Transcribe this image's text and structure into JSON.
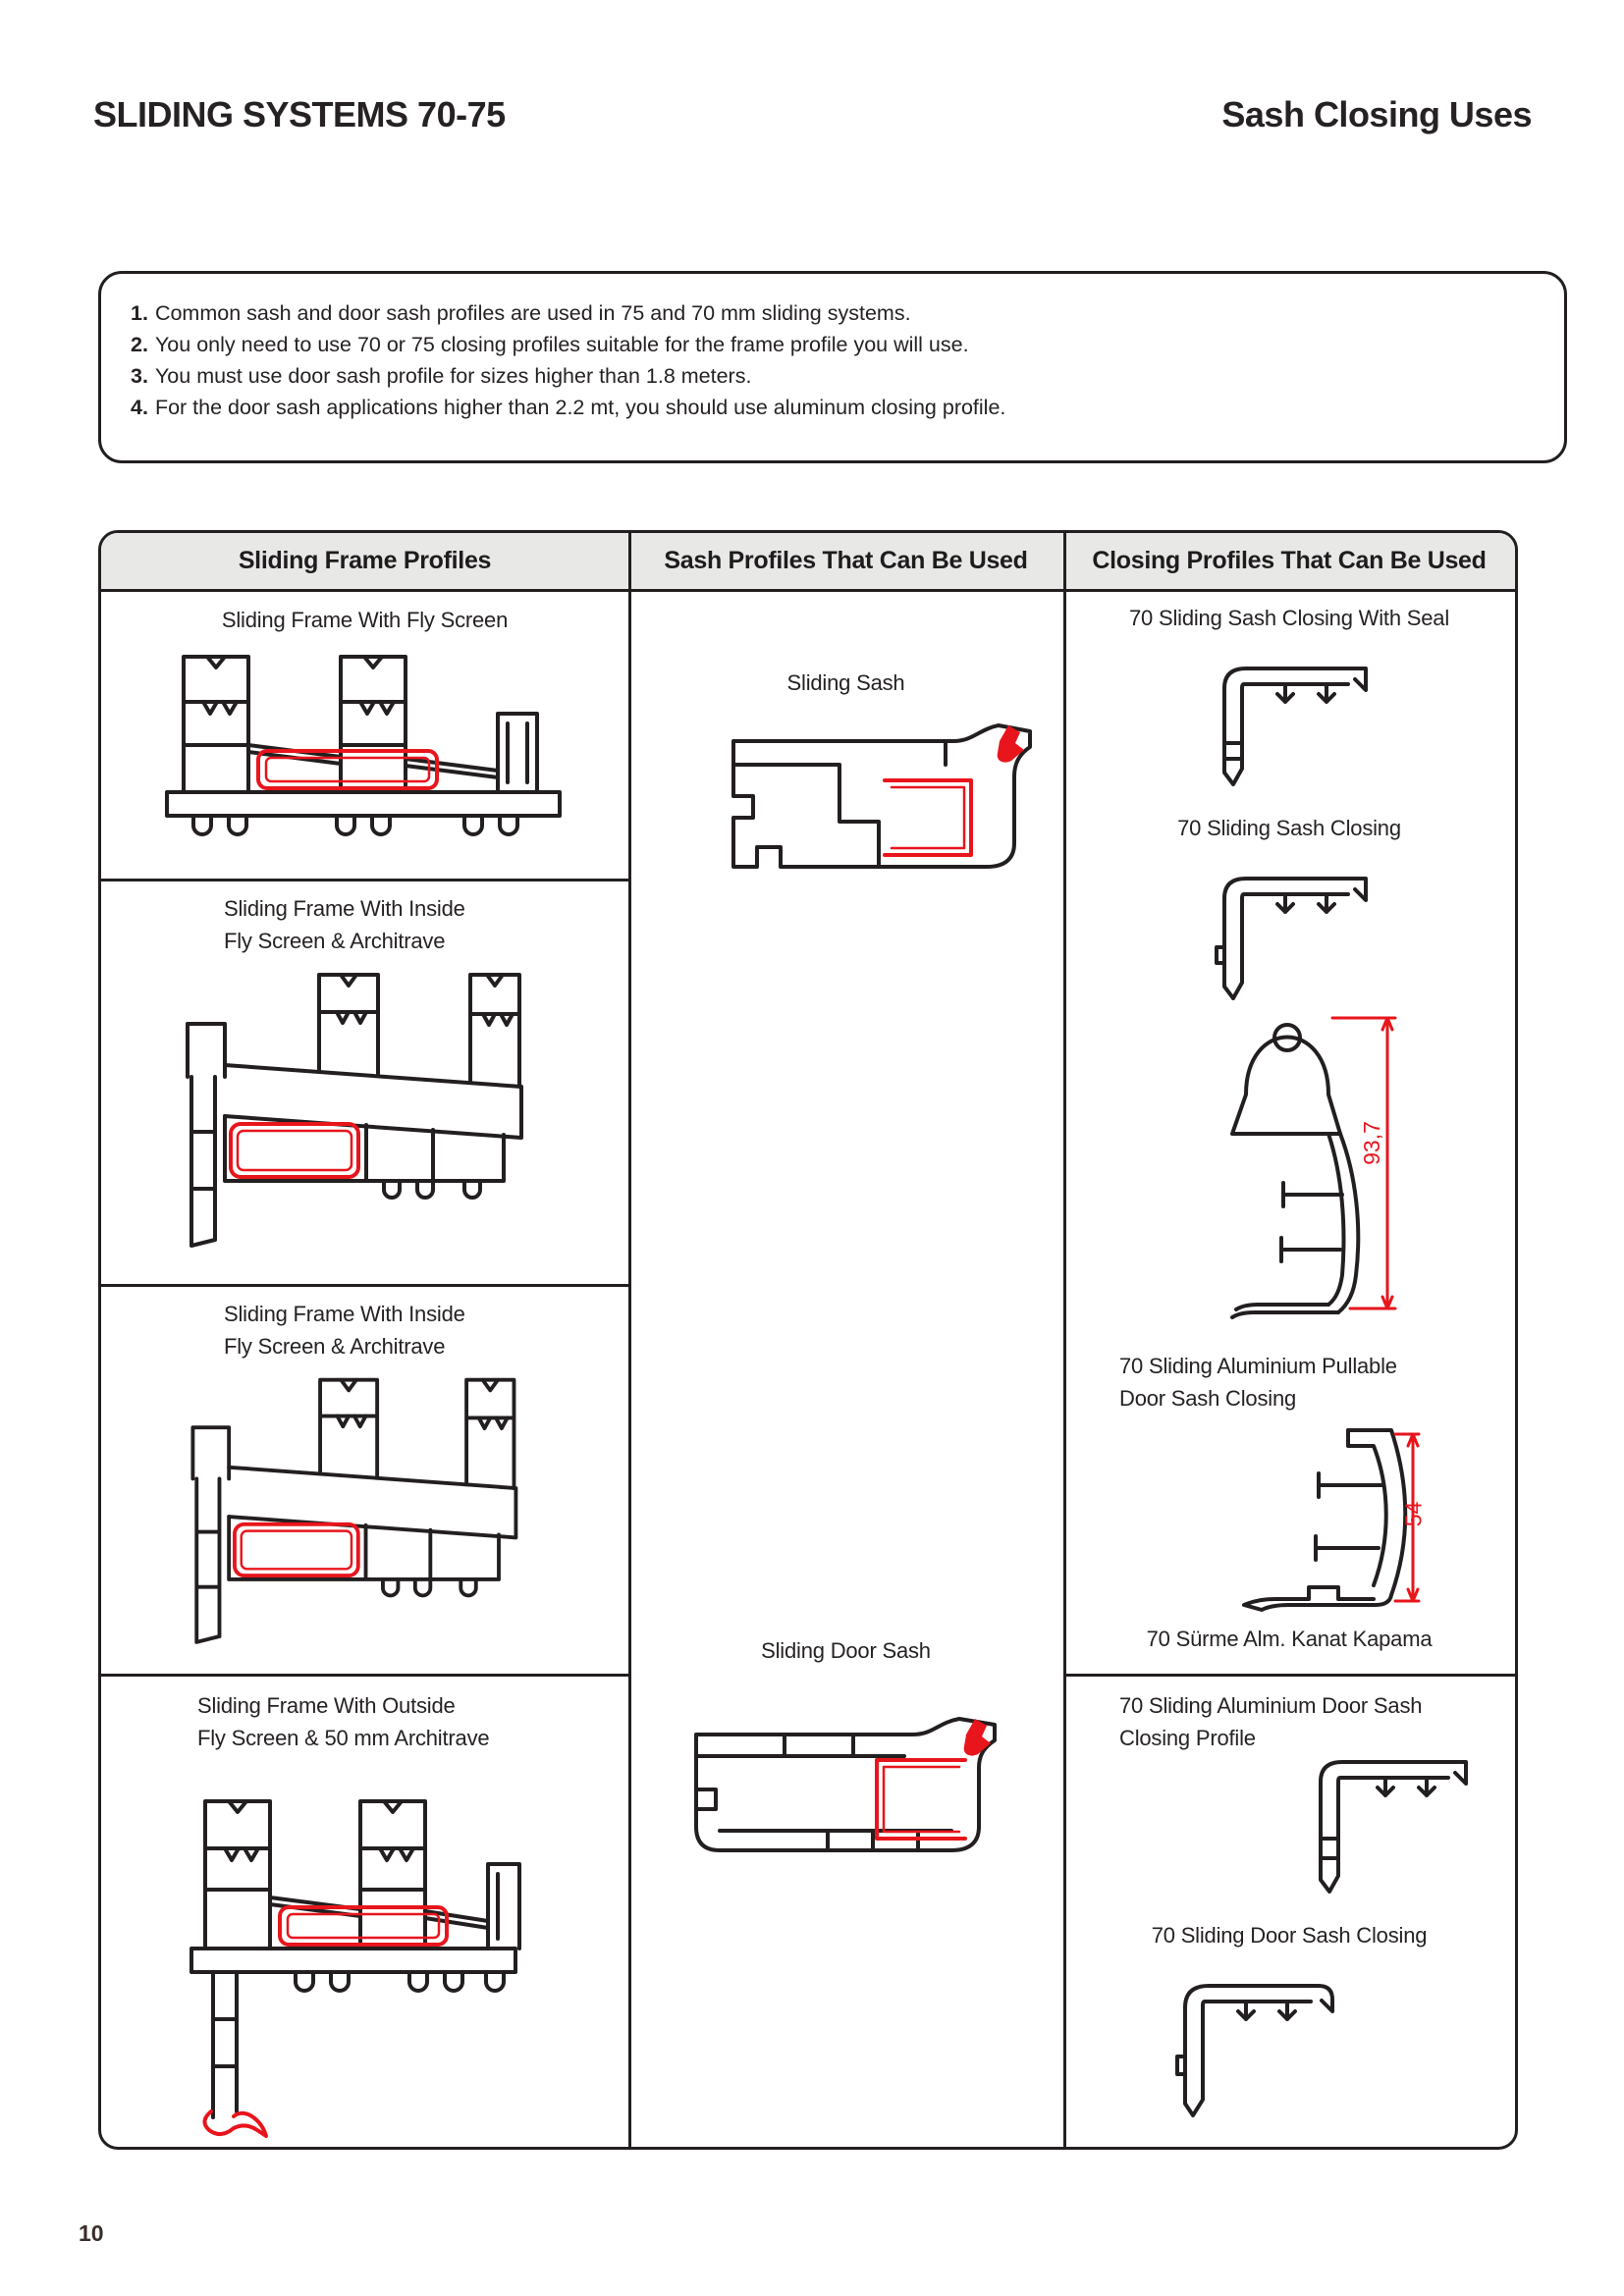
{
  "page": {
    "title_left": "SLIDING SYSTEMS 70-75",
    "title_right": "Sash Closing Uses",
    "page_number": "10"
  },
  "notes": [
    {
      "num": "1.",
      "text": "Common sash and door sash profiles are used in 75 and 70 mm sliding systems."
    },
    {
      "num": "2.",
      "text": "You only need to use 70 or 75  closing profiles suitable for the frame profile you will use."
    },
    {
      "num": "3.",
      "text": "You must use door sash profile for sizes higher than  1.8 meters."
    },
    {
      "num": "4.",
      "text": "For the door sash applications higher than 2.2 mt, you should use aluminum closing profile."
    }
  ],
  "table": {
    "headers": [
      "Sliding Frame Profiles",
      "Sash Profiles That Can Be Used",
      "Closing Profiles That Can Be Used"
    ],
    "col1": {
      "row1_label": "Sliding Frame With Fly Screen",
      "row2_line1": "Sliding Frame With Inside",
      "row2_line2": "Fly Screen & Architrave",
      "row3_line1": "Sliding Frame With Inside",
      "row3_line2": "Fly Screen & Architrave",
      "row4_line1": "Sliding Frame With Outside",
      "row4_line2": "Fly Screen & 50 mm Architrave"
    },
    "col2": {
      "top_label": "Sliding Sash",
      "bottom_label": "Sliding Door Sash"
    },
    "col3": {
      "label1": "70 Sliding Sash Closing With Seal",
      "label2": "70  Sliding Sash Closing",
      "dim1": "93,7",
      "label3_line1": "70 Sliding Aluminium Pullable",
      "label3_line2": "Door Sash Closing",
      "dim2": "54",
      "label4": "70 Sürme Alm. Kanat Kapama",
      "label5_line1": "70 Sliding Aluminium Door Sash",
      "label5_line2": "Closing Profile",
      "label6": "70 Sliding Door Sash Closing"
    }
  },
  "colors": {
    "accent_red": "#e8151c",
    "line_black": "#231f20",
    "header_bg": "#e8e8e7"
  }
}
